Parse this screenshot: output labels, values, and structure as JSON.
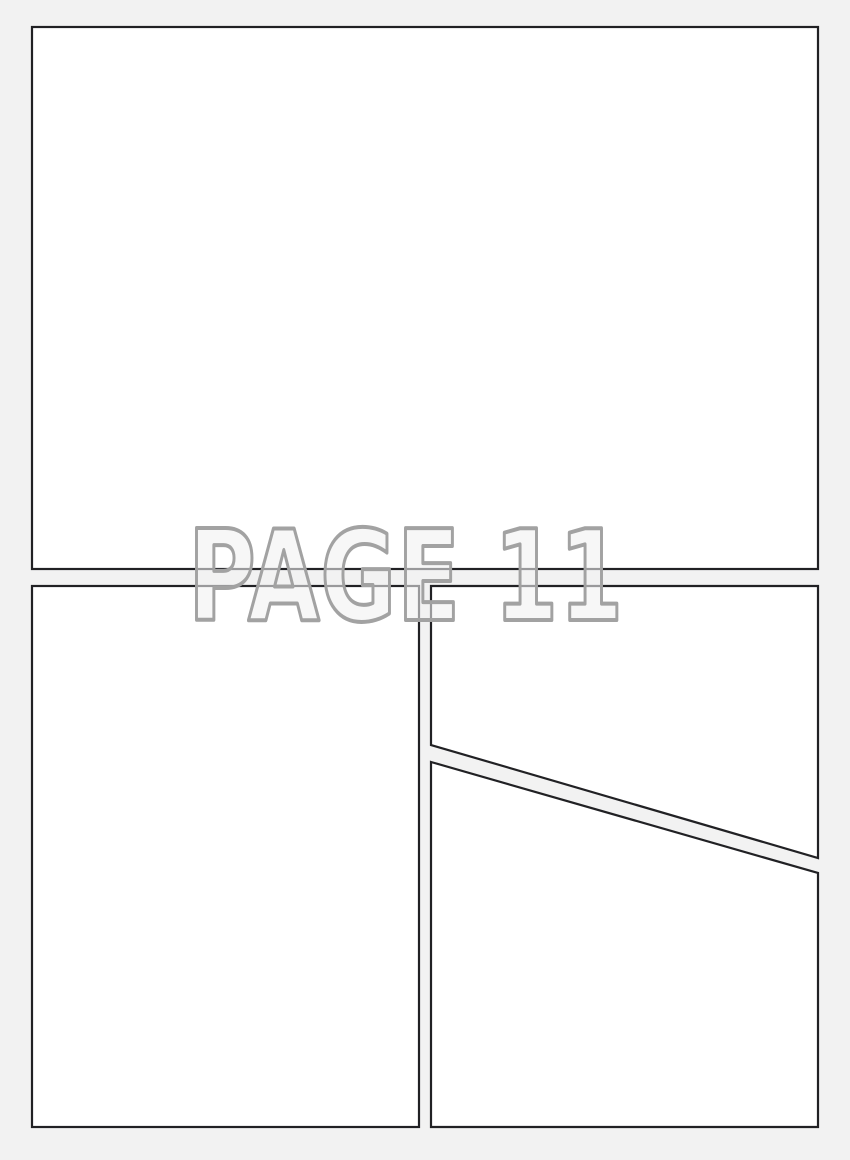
{
  "page": {
    "label": "PAGE 11"
  },
  "panels": {
    "count": 4,
    "names": [
      "top-full-width-panel",
      "bottom-left-panel",
      "right-upper-diagonal-panel",
      "right-lower-diagonal-panel"
    ]
  },
  "colors": {
    "background": "#f2f2f2",
    "panel_fill": "#ffffff",
    "panel_border": "#212124",
    "label_fill": "#f2f2f2",
    "label_outline": "#a2a2a2"
  }
}
